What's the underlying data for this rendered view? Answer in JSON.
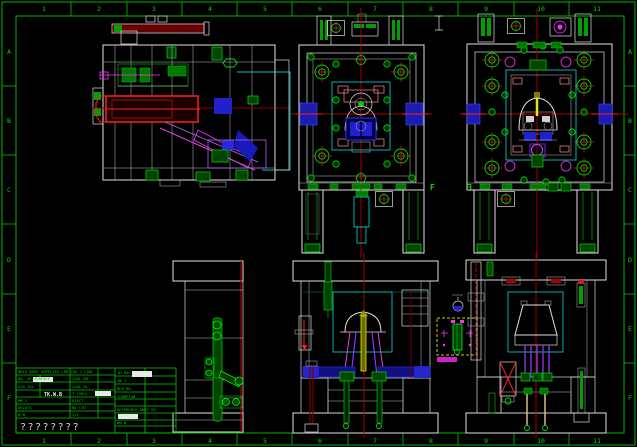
{
  "colors": {
    "background": "#000000",
    "sheet_frame_green": "#00b400",
    "outline_white": "#e0e0e0",
    "centerline_red": "#b40000",
    "bright_red": "#ff2020",
    "component_green": "#00dd00",
    "slider_magenta": "#e040e0",
    "ejector_purple": "#8833e0",
    "slide_blue": "#1c1cae",
    "cavity_cyan": "#00c4c4",
    "sprue_yellow": "#e8e800",
    "detail_box_yellow": "#cccc00"
  },
  "frame": {
    "top_numbers": [
      "1",
      "2",
      "3",
      "4",
      "5",
      "6",
      "7",
      "8",
      "9",
      "10",
      "11"
    ],
    "bottom_numbers": [
      "1",
      "2",
      "3",
      "4",
      "5",
      "6",
      "7",
      "8",
      "9",
      "10",
      "11"
    ],
    "left_letters": [
      "A",
      "B",
      "C",
      "D",
      "E",
      "F"
    ],
    "right_letters": [
      "A",
      "B",
      "C",
      "D",
      "E",
      "F"
    ]
  },
  "markers": {
    "section_left": "F",
    "section_right": "F"
  },
  "title_block": {
    "top_row": "MOLD BASE SUPPLIER  LKM  CAV 1  COOL",
    "left_rows": [
      "NO. OF SURFACE",
      "AIR TOL",
      "TK.W.B",
      "MM 2",
      "DELAYS",
      "W.W"
    ],
    "mid_rows": [
      "COOL NO.",
      "COOL HL.",
      "T CIRCL.",
      "EJECT",
      "NO CYD",
      "1/1"
    ],
    "right_rows": [
      "1H.00S",
      "ZW 1",
      "MLD NO.",
      "CHAMPION",
      "REFERENCE UNIT BY",
      "WW.W"
    ],
    "unknown_row": "????????"
  }
}
